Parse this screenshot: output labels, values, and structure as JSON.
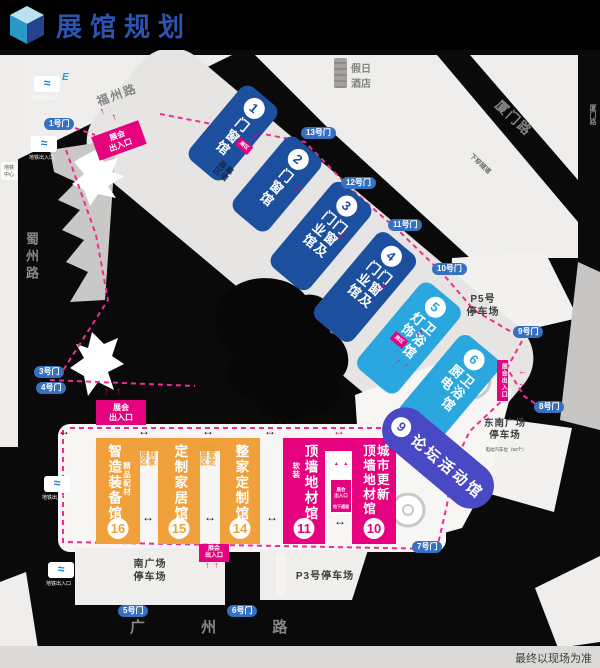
{
  "header": {
    "title": "展馆规划"
  },
  "footer": {
    "note": "最终以现场为准"
  },
  "colors": {
    "blue": "#1c4f9e",
    "cyan": "#2aa7df",
    "indigo": "#4a49c5",
    "orange": "#f1a13b",
    "magenta": "#e6017e",
    "gate_blue": "#3570c1",
    "title_blue": "#2b55b0"
  },
  "roads": {
    "fuzhou": "福州路",
    "xiamen": "厦门路",
    "tunnel": "下穿隧道",
    "shuzhou": "蜀州路",
    "guangzhou": "广 州 路",
    "right_edge": "厦门路"
  },
  "hotel": "假日\n酒店",
  "landmark": {
    "metro_center": "地铁\n中心"
  },
  "metro": {
    "label": "地铁出入口",
    "letter": "E"
  },
  "gates": {
    "g1": "1号门",
    "g3": "3号门",
    "g4": "4号门",
    "g5": "5号门",
    "g6": "6号门",
    "g7": "7号门",
    "g8": "8号门",
    "g9": "9号门",
    "g10": "10号门",
    "g11": "11号门",
    "g12": "12号门",
    "g13": "13号门"
  },
  "halls": {
    "h1": {
      "num": "1",
      "name": "门窗馆"
    },
    "h2": {
      "num": "2",
      "name": "门窗馆"
    },
    "h3": {
      "num": "3",
      "name": "门窗及\n门业馆"
    },
    "h4": {
      "num": "4",
      "name": "门窗及\n门业馆"
    },
    "h5": {
      "num": "5",
      "name": "卫浴馆\n灯饰"
    },
    "h6": {
      "num": "6",
      "name": "卫浴馆\n厨电"
    },
    "h9": {
      "num": "9",
      "name": "论坛活动馆"
    },
    "h10": {
      "num": "10",
      "name": "城市更新\n顶墙地材馆"
    },
    "h11": {
      "num": "11",
      "name": "顶墙地材馆",
      "side": "软装"
    },
    "h14": {
      "num": "14",
      "name": "整家定制馆"
    },
    "h15": {
      "num": "15",
      "name": "定制家居馆"
    },
    "h16": {
      "num": "16",
      "name": "智造装备馆",
      "side": "精品配材"
    }
  },
  "zones": {
    "custom_home": "定制家\n居展区",
    "whole_home": "整家定\n制展区",
    "curtain": "幕墙\n展区",
    "sub_badge": "展区"
  },
  "entrances": {
    "main": "展会\n出入口",
    "vertical": "展会出入口",
    "mini": {
      "name": "展会\n出入口",
      "sub": "地下通道"
    }
  },
  "parking": {
    "p5": "P5号\n停车场",
    "southeast": "东南广场\n停车场",
    "southeast_note": "电动汽车位（52个）",
    "south": "南广场\n停车场",
    "p3": "P3号停车场"
  },
  "icons": {
    "up": "↑",
    "left": "←",
    "both": "↔",
    "tri": "▲",
    "wave": "≈"
  }
}
